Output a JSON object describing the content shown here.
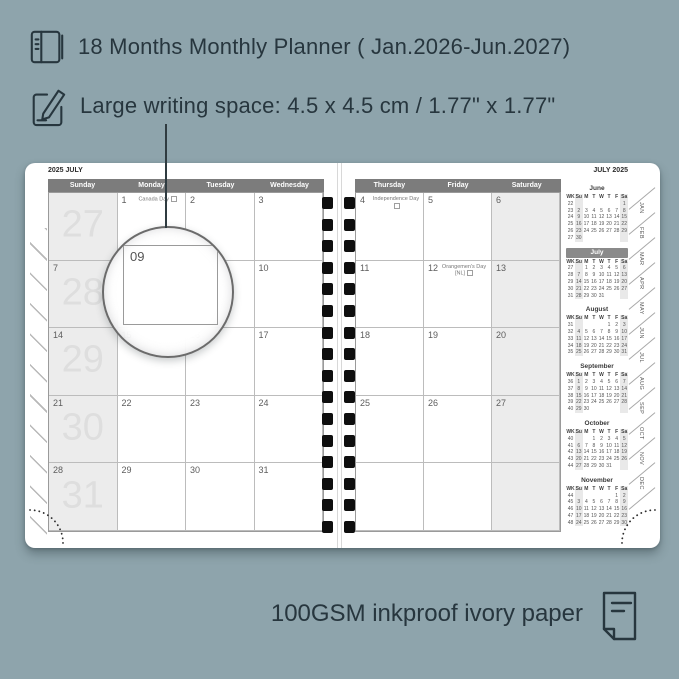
{
  "colors": {
    "background": "#8ea4ac",
    "ink": "#27363e",
    "page": "#ffffff",
    "header_band": "#7c7c7c",
    "shaded_column": "#ececec",
    "mini_highlight": "#8a8a8a",
    "spiral": "#0e0e0e"
  },
  "features": [
    {
      "icon": "notebook-icon",
      "text": "18 Months Monthly Planner ( Jan.2026-Jun.2027)"
    },
    {
      "icon": "pencil-icon",
      "text": "Large writing space: 4.5 x 4.5 cm / 1.77\" x 1.77\""
    }
  ],
  "footer": {
    "icon": "paper-icon",
    "text": "100GSM inkproof ivory paper"
  },
  "magnifier": {
    "label": "09"
  },
  "planner": {
    "left_page": {
      "corner_label": "2025 JULY",
      "day_headers": [
        "Sunday",
        "Monday",
        "Tuesday",
        "Wednesday"
      ],
      "weeks": [
        {
          "week_number": "27",
          "cells": [
            {
              "d": ""
            },
            {
              "d": "1",
              "holiday": "Canada Day"
            },
            {
              "d": "2"
            },
            {
              "d": "3"
            }
          ]
        },
        {
          "week_number": "28",
          "cells": [
            {
              "d": "7"
            },
            {
              "d": "8"
            },
            {
              "d": "9"
            },
            {
              "d": "10"
            }
          ]
        },
        {
          "week_number": "29",
          "cells": [
            {
              "d": "14"
            },
            {
              "d": "15"
            },
            {
              "d": "16"
            },
            {
              "d": "17"
            }
          ]
        },
        {
          "week_number": "30",
          "cells": [
            {
              "d": "21"
            },
            {
              "d": "22"
            },
            {
              "d": "23"
            },
            {
              "d": "24"
            }
          ]
        },
        {
          "week_number": "31",
          "cells": [
            {
              "d": "28"
            },
            {
              "d": "29"
            },
            {
              "d": "30"
            },
            {
              "d": "31"
            }
          ]
        }
      ]
    },
    "right_page": {
      "corner_label": "JULY 2025",
      "day_headers": [
        "Thursday",
        "Friday",
        "Saturday"
      ],
      "weeks": [
        {
          "cells": [
            {
              "d": "4",
              "holiday": "Independence Day"
            },
            {
              "d": "5"
            },
            {
              "d": "6"
            }
          ]
        },
        {
          "cells": [
            {
              "d": "11"
            },
            {
              "d": "12",
              "holiday": "Orangemen's Day",
              "holiday2": "[NL]"
            },
            {
              "d": "13"
            }
          ]
        },
        {
          "cells": [
            {
              "d": "18"
            },
            {
              "d": "19"
            },
            {
              "d": "20"
            }
          ]
        },
        {
          "cells": [
            {
              "d": "25"
            },
            {
              "d": "26"
            },
            {
              "d": "27"
            }
          ]
        },
        {
          "cells": [
            {
              "d": ""
            },
            {
              "d": ""
            },
            {
              "d": ""
            }
          ]
        }
      ]
    },
    "mini_col_headers": [
      "WK",
      "Su",
      "M",
      "T",
      "W",
      "T",
      "F",
      "Sa"
    ],
    "mini_calendars": [
      {
        "month": "June",
        "highlight": false,
        "rows": [
          [
            "22",
            "",
            "",
            "",
            "",
            "",
            "",
            "1"
          ],
          [
            "23",
            "2",
            "3",
            "4",
            "5",
            "6",
            "7",
            "8"
          ],
          [
            "24",
            "9",
            "10",
            "11",
            "12",
            "13",
            "14",
            "15"
          ],
          [
            "25",
            "16",
            "17",
            "18",
            "19",
            "20",
            "21",
            "22"
          ],
          [
            "26",
            "23",
            "24",
            "25",
            "26",
            "27",
            "28",
            "29"
          ],
          [
            "27",
            "30",
            "",
            "",
            "",
            "",
            "",
            ""
          ]
        ]
      },
      {
        "month": "July",
        "highlight": true,
        "rows": [
          [
            "27",
            "",
            "1",
            "2",
            "3",
            "4",
            "5",
            "6"
          ],
          [
            "28",
            "7",
            "8",
            "9",
            "10",
            "11",
            "12",
            "13"
          ],
          [
            "29",
            "14",
            "15",
            "16",
            "17",
            "18",
            "19",
            "20"
          ],
          [
            "30",
            "21",
            "22",
            "23",
            "24",
            "25",
            "26",
            "27"
          ],
          [
            "31",
            "28",
            "29",
            "30",
            "31",
            "",
            "",
            ""
          ]
        ]
      },
      {
        "month": "August",
        "highlight": false,
        "rows": [
          [
            "31",
            "",
            "",
            "",
            "",
            "1",
            "2",
            "3"
          ],
          [
            "32",
            "4",
            "5",
            "6",
            "7",
            "8",
            "9",
            "10"
          ],
          [
            "33",
            "11",
            "12",
            "13",
            "14",
            "15",
            "16",
            "17"
          ],
          [
            "34",
            "18",
            "19",
            "20",
            "21",
            "22",
            "23",
            "24"
          ],
          [
            "35",
            "25",
            "26",
            "27",
            "28",
            "29",
            "30",
            "31"
          ]
        ]
      },
      {
        "month": "September",
        "highlight": false,
        "rows": [
          [
            "36",
            "1",
            "2",
            "3",
            "4",
            "5",
            "6",
            "7"
          ],
          [
            "37",
            "8",
            "9",
            "10",
            "11",
            "12",
            "13",
            "14"
          ],
          [
            "38",
            "15",
            "16",
            "17",
            "18",
            "19",
            "20",
            "21"
          ],
          [
            "39",
            "22",
            "23",
            "24",
            "25",
            "26",
            "27",
            "28"
          ],
          [
            "40",
            "29",
            "30",
            "",
            "",
            "",
            "",
            ""
          ]
        ]
      },
      {
        "month": "October",
        "highlight": false,
        "rows": [
          [
            "40",
            "",
            "",
            "1",
            "2",
            "3",
            "4",
            "5"
          ],
          [
            "41",
            "6",
            "7",
            "8",
            "9",
            "10",
            "11",
            "12"
          ],
          [
            "42",
            "13",
            "14",
            "15",
            "16",
            "17",
            "18",
            "19"
          ],
          [
            "43",
            "20",
            "21",
            "22",
            "23",
            "24",
            "25",
            "26"
          ],
          [
            "44",
            "27",
            "28",
            "29",
            "30",
            "31",
            "",
            ""
          ]
        ]
      },
      {
        "month": "November",
        "highlight": false,
        "rows": [
          [
            "44",
            "",
            "",
            "",
            "",
            "",
            "1",
            "2"
          ],
          [
            "45",
            "3",
            "4",
            "5",
            "6",
            "7",
            "8",
            "9"
          ],
          [
            "46",
            "10",
            "11",
            "12",
            "13",
            "14",
            "15",
            "16"
          ],
          [
            "47",
            "17",
            "18",
            "19",
            "20",
            "21",
            "22",
            "23"
          ],
          [
            "48",
            "24",
            "25",
            "26",
            "27",
            "28",
            "29",
            "30"
          ]
        ]
      }
    ],
    "month_tabs": [
      "JAN",
      "FEB",
      "MAR",
      "APR",
      "MAY",
      "JUN",
      "JUL",
      "AUG",
      "SEP",
      "OCT",
      "NOV",
      "DEC"
    ]
  }
}
